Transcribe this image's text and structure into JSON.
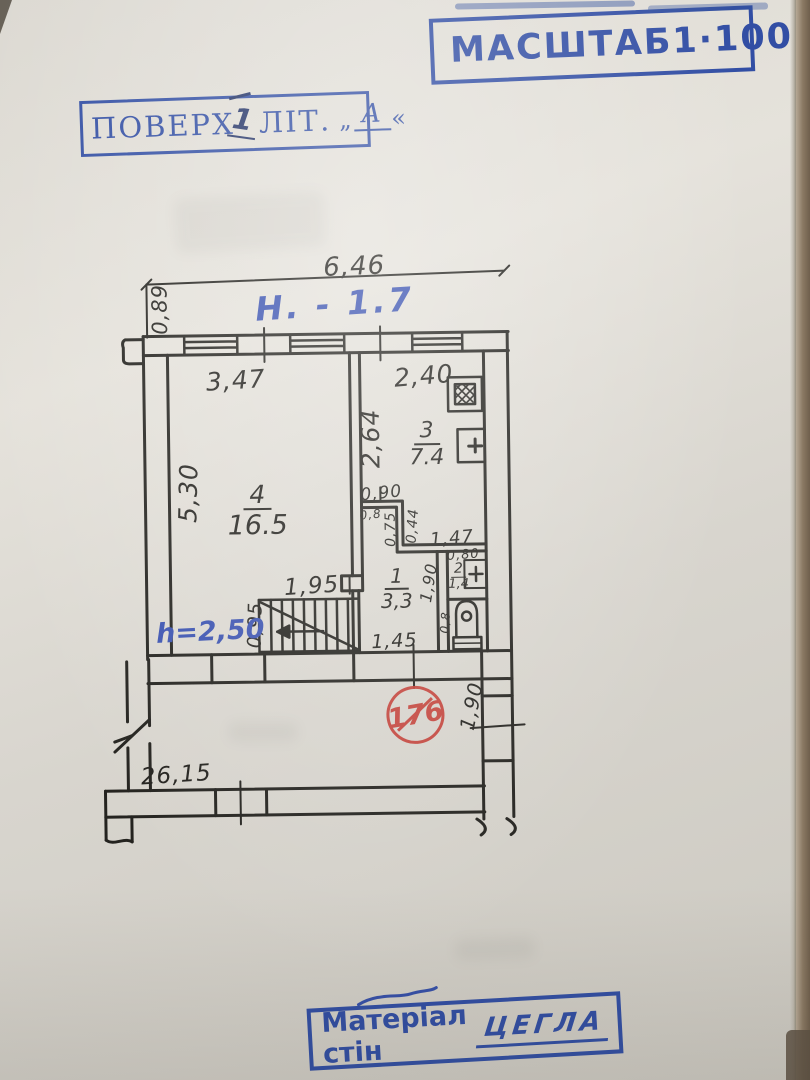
{
  "stamps": {
    "scale": {
      "label": "МАСШТАБ",
      "value": "1·100"
    },
    "floor": {
      "prefix": "ПОВЕРХ",
      "mark": "1",
      "label": "ЛІТ.",
      "quote_open": "„",
      "letter": "А",
      "quote_close": "«"
    },
    "material": {
      "label": "Матеріал стін",
      "value": "ЦЕГЛА"
    },
    "unit": {
      "number": "176"
    }
  },
  "notes": {
    "ceiling": "Н. - 1.7",
    "room_height": "h=2,50"
  },
  "plan": {
    "dims": {
      "top_width": "6,46",
      "left_offset": "0,89",
      "room4_width": "3,47",
      "room3_width": "2,40",
      "room3_depth": "2,64",
      "room4_depth": "5,30",
      "door_width": "0,90",
      "nook_left": "0,8",
      "nook_depth": "0,75",
      "jog_width": "0,44",
      "bath_width": "1,47",
      "wc_width": "0,80",
      "hall_depth": "1,90",
      "wc_side": "0,8",
      "hall_width": "1,95",
      "stair_width": "0,95",
      "hall_bottom_width": "1,45",
      "passage_depth": "1,90",
      "building_length": "26,15"
    },
    "rooms": [
      {
        "number": "4",
        "area": "16.5"
      },
      {
        "number": "3",
        "area": "7.4"
      },
      {
        "number": "1",
        "area": "3,3"
      },
      {
        "number": "2",
        "area": "1,4"
      }
    ]
  }
}
